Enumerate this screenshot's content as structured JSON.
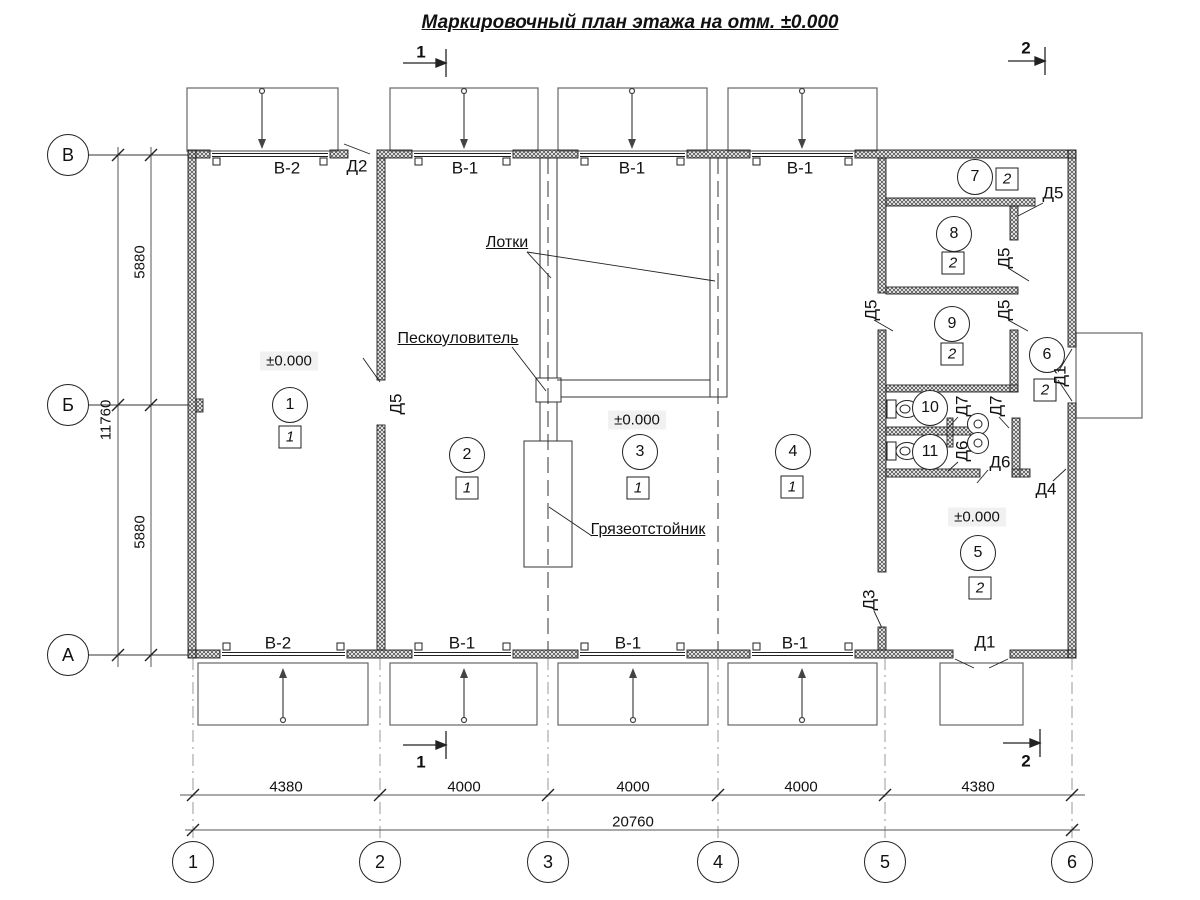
{
  "title": "Маркировочный план этажа на отм. ±0.000",
  "sections": {
    "s1": "1",
    "s2": "2"
  },
  "axes": {
    "rows": [
      "В",
      "Б",
      "А"
    ],
    "cols": [
      "1",
      "2",
      "3",
      "4",
      "5",
      "6"
    ]
  },
  "dims": {
    "left_segments": [
      "5880",
      "5880"
    ],
    "left_total": "11760",
    "bottom_segments": [
      "4380",
      "4000",
      "4000",
      "4000",
      "4380"
    ],
    "bottom_total": "20760"
  },
  "elevation": "±0.000",
  "gates": {
    "v1": "В-1",
    "v2": "В-2"
  },
  "doors": {
    "d1": "Д1",
    "d2": "Д2",
    "d3": "Д3",
    "d4": "Д4",
    "d5": "Д5",
    "d6": "Д6",
    "d7": "Д7"
  },
  "rooms": [
    {
      "num": "1",
      "cat": "1"
    },
    {
      "num": "2",
      "cat": "1"
    },
    {
      "num": "3",
      "cat": "1"
    },
    {
      "num": "4",
      "cat": "1"
    },
    {
      "num": "5",
      "cat": "2"
    },
    {
      "num": "6",
      "cat": "2"
    },
    {
      "num": "7",
      "cat": "2"
    },
    {
      "num": "8",
      "cat": "2"
    },
    {
      "num": "9",
      "cat": "2"
    },
    {
      "num": "10"
    },
    {
      "num": "11"
    }
  ],
  "annotations": {
    "trays": "Лотки",
    "sand_trap": "Пескоуловитель",
    "mud_collector": "Грязеотстойник"
  }
}
